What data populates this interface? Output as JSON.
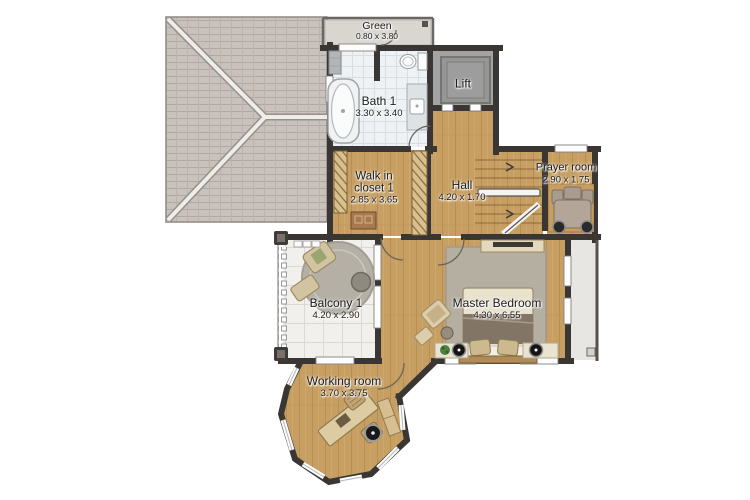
{
  "plan_title": "Upper floor plan",
  "rooms": {
    "green": {
      "name": "Green",
      "dims": "0.80 x 3.80"
    },
    "bath1": {
      "name": "Bath 1",
      "dims": "3.30 x 3.40"
    },
    "lift": {
      "name": "Lift",
      "dims": ""
    },
    "walk_in_closet": {
      "name": "Walk in closet 1",
      "dims": "2.85 x 3.65"
    },
    "hall": {
      "name": "Hall",
      "dims": "4.20 x 1.70"
    },
    "prayer_room": {
      "name": "Prayer room",
      "dims": "2.90 x 1.75"
    },
    "balcony1": {
      "name": "Balcony 1",
      "dims": "4.20 x 2.90"
    },
    "master_bedroom": {
      "name": "Master Bedroom",
      "dims": "4.30 x 6.55"
    },
    "working_room": {
      "name": "Working room",
      "dims": "3.70 x 3.75"
    }
  },
  "colors": {
    "wall": "#3a3633",
    "wood": "#c79f63",
    "tile_bath": "#eef2f4",
    "tile_balcony": "#f1f0ec",
    "roof": "#c9c1bb",
    "lift_floor": "#a3a3a3",
    "terrace": "#e7e6e2",
    "rug": "#b5b0a6",
    "text": "#1c1c1c"
  }
}
